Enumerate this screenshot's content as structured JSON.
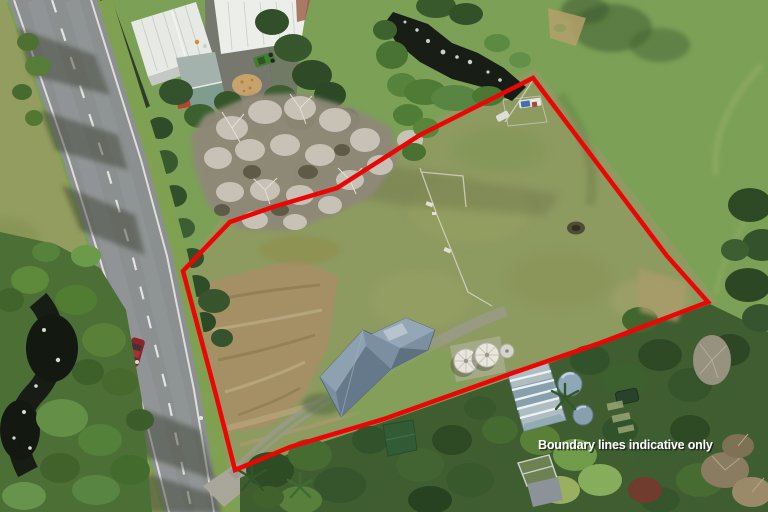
{
  "overlay": {
    "caption": "Boundary lines indicative only",
    "caption_color": "#ffffff",
    "boundary_color": "#ee0202",
    "boundary_line_width": 4.5,
    "boundary_points": "183,271 230,222 273,207 337,188 420,135 533,78 667,256 708,302 600,343 510,374 384,419 290,447 235,470 216,395 196,320"
  },
  "scene": {
    "road_color": "#8b8f90",
    "road_marking_color": "#e8e8e4",
    "neighbor_field_color": "#7aa055",
    "property_paddock_color": "#8d9a5f",
    "dirt_color": "#a59064",
    "house_roof_color": "#7b8fa1",
    "stream_color": "#151a12",
    "bare_tree_color": "#cfc9bf",
    "tank_color": "#e9e7df",
    "car_color": "#8e2126",
    "greenhouse_color": "#aebec4",
    "shed_color": "#2f5a33"
  }
}
